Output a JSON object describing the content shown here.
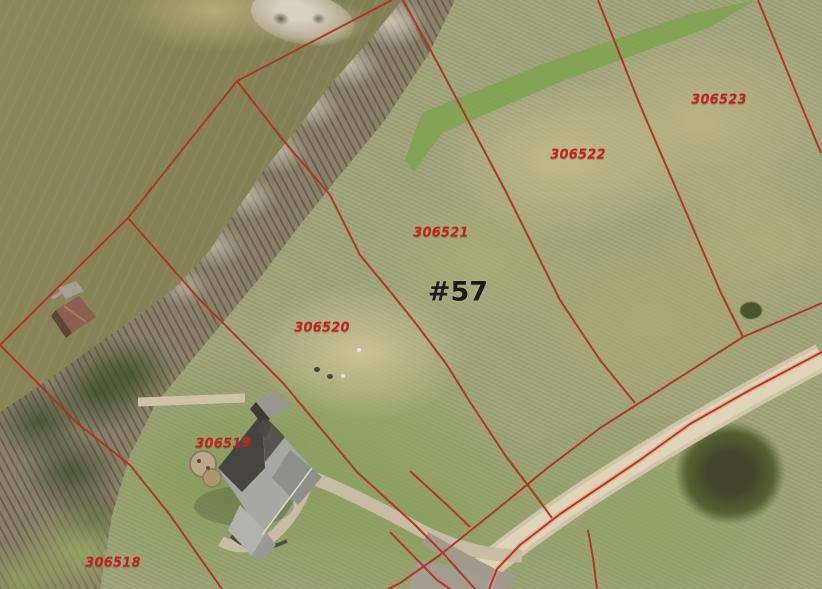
{
  "map": {
    "type": "parcel-aerial-view",
    "lot_marker": "#57",
    "parcels": [
      {
        "label": "306518"
      },
      {
        "label": "306519"
      },
      {
        "label": "306520"
      },
      {
        "label": "306521"
      },
      {
        "label": "306522"
      },
      {
        "label": "306523"
      }
    ],
    "features": {
      "lake": "lake-water",
      "shoreline_trees": "tree-band",
      "house": "house-roof",
      "boathouse": "boathouse-roof",
      "road": "gravel-road",
      "driveway": "driveway"
    },
    "colors": {
      "parcel_line_red": "#b03124",
      "parcel_label_red": "#c2201a",
      "lot_marker_black": "#1b1b1b",
      "road_tan": "#d9cfb2",
      "water_olive": "#807e52",
      "grass_green": "#8ca05e"
    }
  }
}
